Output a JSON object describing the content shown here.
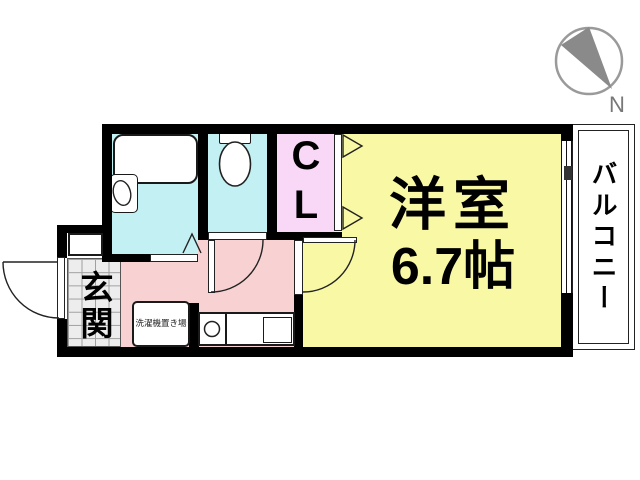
{
  "compass": {
    "label": "N"
  },
  "rooms": {
    "main_room": {
      "name": "洋室",
      "size": "6.7帖"
    },
    "closet": {
      "label": "CL"
    },
    "entrance": {
      "label": "玄関"
    },
    "balcony": {
      "label": "バルコニー"
    },
    "laundry": {
      "label": "洗濯機置き場"
    }
  },
  "colors": {
    "wall": "#000000",
    "water": "#c3f0f2",
    "closet_fill": "#f8d8f6",
    "room_fill": "#f9f8a5",
    "kitchen": "#f8d2d2",
    "tile": "#ededed",
    "tile_line": "#a0a0a0",
    "compass": "#8a8a8a",
    "outline": "#222222"
  }
}
